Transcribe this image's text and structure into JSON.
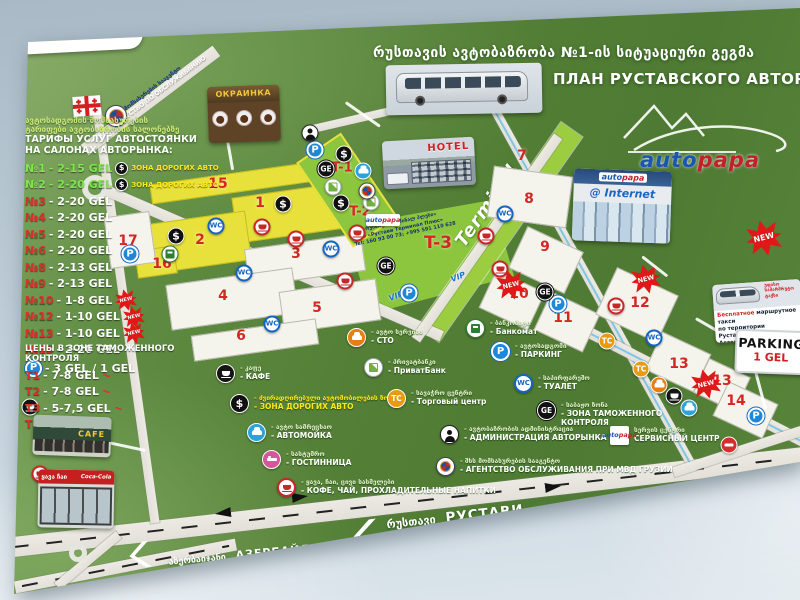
{
  "poster": {
    "title_ka": "რუსთავის ავტობაზრობა №1-ის სიტუაციური გეგმა",
    "title_ru": "ПЛАН РУСТАВСКОГО АВТОРЫНКА №1"
  },
  "badges": {
    "new_label": "NEW"
  },
  "tariff_board": {
    "header_ka1": "ავტოსადგომის მომსახურების",
    "header_ka2": "ტარიფები ავტობაზრობის სალონებზე",
    "header_ru1": "ТАРИФЫ УСЛУГ АВТОСТОЯНКИ",
    "header_ru2": "НА САЛОНАХ АВТОРЫНКА:",
    "rows": [
      {
        "label": "№1",
        "price": "- 2-15 GEL",
        "accent": "green",
        "dollar": true,
        "zone": "ЗОНА ДОРОГИХ АВТО"
      },
      {
        "label": "№2",
        "price": "- 2-20 GEL",
        "accent": "green",
        "dollar": true,
        "zone": "ЗОНА ДОРОГИХ АВТО"
      },
      {
        "label": "№3",
        "price": "- 2-20 GEL",
        "accent": "red"
      },
      {
        "label": "№4",
        "price": "- 2-20 GEL",
        "accent": "red"
      },
      {
        "label": "№5",
        "price": "- 2-20 GEL",
        "accent": "red"
      },
      {
        "label": "№6",
        "price": "- 2-20 GEL",
        "accent": "red"
      },
      {
        "label": "№8",
        "price": "- 2-13 GEL",
        "accent": "red"
      },
      {
        "label": "№9",
        "price": "- 2-13 GEL",
        "accent": "red"
      },
      {
        "label": "№10",
        "price": "- 1-8 GEL",
        "accent": "red",
        "new": true
      },
      {
        "label": "№12",
        "price": "- 1-10 GEL",
        "accent": "red",
        "new": true
      },
      {
        "label": "№13",
        "price": "- 1-10 GEL",
        "accent": "red",
        "new": true
      },
      {
        "label": "№15",
        "price": "- 2-20 GEL",
        "accent": "red"
      }
    ],
    "parking_price": "- 3 GEL / 1 GEL"
  },
  "customs_board": {
    "header": "ЦЕНЫ В ЗОНЕ ТАМОЖЕННОГО КОНТРОЛЯ",
    "rows": [
      {
        "label": "T1",
        "price": "- 7-8 GEL",
        "scribble": true
      },
      {
        "label": "T2",
        "price": "- 7-8 GEL",
        "scribble": true
      },
      {
        "label": "T3",
        "price": "- 5-7,5 GEL",
        "scribble": true
      },
      {
        "label": "T4",
        "price": "- 7 GEL",
        "scribble": false
      }
    ]
  },
  "legend": {
    "items": [
      {
        "icon": "cafe",
        "x": 226,
        "y": 374,
        "ka": "- კაფე",
        "ru": "- КАФЕ"
      },
      {
        "icon": "dollar",
        "x": 240,
        "y": 404,
        "ka": "- ძვირადღირებული ავტომობილების ზონა",
        "ru": "- ЗОНА ДОРОГИХ АВТО",
        "yellow": true
      },
      {
        "icon": "carwash",
        "x": 257,
        "y": 433,
        "ka": "- ავტო სამრეცხაო",
        "ru": "- АВТОМОЙКА"
      },
      {
        "icon": "bed",
        "x": 272,
        "y": 460,
        "ka": "- სასტუმრო",
        "ru": "- ГОСТИННИЦА"
      },
      {
        "icon": "coffee",
        "x": 287,
        "y": 488,
        "ka": "- ყავა, ჩაი, ცივი სასმელები",
        "ru": "- КОФЕ, ЧАЙ, ПРОХЛАДИТЕЛЬНЫЕ НАПИТКИ"
      },
      {
        "icon": "sto",
        "x": 357,
        "y": 338,
        "ka": "- ავტო სერვისი",
        "ru": "- СТО"
      },
      {
        "icon": "privat",
        "x": 374,
        "y": 368,
        "ka": "- პრივატბანკი",
        "ru": "- ПриватБанк"
      },
      {
        "icon": "tc",
        "x": 397,
        "y": 399,
        "ka": "- სავაჭრო ცენტრი",
        "ru": "- Торговый центр"
      },
      {
        "icon": "admin",
        "x": 450,
        "y": 435,
        "ka": "- ავტობაზრობის ადმინისტრაცია",
        "ru": "- АДМИНИСТРАЦИЯ АВТОРЫНКА"
      },
      {
        "icon": "emblem",
        "x": 446,
        "y": 467,
        "ka": "- შსს მომსახურების სააგენტო",
        "ru": "- АГЕНТСТВО ОБСЛУЖИВАНИЯ ПРИ МВД ГРУЗИИ"
      },
      {
        "icon": "atm",
        "x": 476,
        "y": 329,
        "ka": "- ბანკომატი",
        "ru": "- Банкомат"
      },
      {
        "icon": "parking",
        "x": 501,
        "y": 352,
        "ka": "- ავტოსადგომი",
        "ru": "- ПАРКИНГ"
      },
      {
        "icon": "wc",
        "x": 524,
        "y": 384,
        "ka": "- საპირფარეშო",
        "ru": "- ТУАЛЕТ"
      },
      {
        "icon": "ge",
        "x": 547,
        "y": 411,
        "ka": "- საბაჟო ზონა",
        "ru": "- ЗОНА ТАМОЖЕННОГО КОНТРОЛЯ",
        "wide": true
      },
      {
        "icon": "autopapa",
        "x": 620,
        "y": 436,
        "ka": "სერვის ცენტრი",
        "ru": "СЕРВИСНЫЙ ЦЕНТР"
      }
    ]
  },
  "map": {
    "terminal_label": "Terminal",
    "vip": "VIP",
    "mvd_road": {
      "ka": "შ.ს.ს. მომსახურების სააგენტო",
      "ru": "МВД - АГЕНТСТВО ПО ОБСЛУЖИВАНИЮ"
    },
    "t3_text": [
      "შპს «რუსთავი ტერმინალ პლუსი»",
      "ООО «Рустави Терминал Плюс»",
      "Tel: 160 93 00 73; +995 591 110 628"
    ],
    "roads": [
      {
        "cx": 400,
        "cy": 503,
        "len": 830,
        "wid": 20,
        "ang": -6.5,
        "dash": true
      },
      {
        "cx": 125,
        "cy": 566,
        "len": 225,
        "wid": 12,
        "ang": -11,
        "dash": true
      },
      {
        "cx": 88,
        "cy": 560,
        "len": 80,
        "wid": 9,
        "ang": -40
      },
      {
        "cx": 125,
        "cy": 312,
        "len": 425,
        "wid": 9,
        "ang": 82
      },
      {
        "cx": 150,
        "cy": 100,
        "len": 165,
        "wid": 13,
        "ang": -37
      },
      {
        "cx": 272,
        "cy": 262,
        "len": 370,
        "wid": 11,
        "ang": 23.5
      },
      {
        "cx": 585,
        "cy": 273,
        "len": 435,
        "wid": 9,
        "ang": 61,
        "blue": true
      },
      {
        "cx": 487,
        "cy": 238,
        "len": 248,
        "wid": 10,
        "ang": -55
      },
      {
        "cx": 677,
        "cy": 377,
        "len": 285,
        "wid": 11,
        "ang": 27,
        "blue": true
      },
      {
        "cx": 395,
        "cy": 110,
        "len": 180,
        "wid": 8,
        "ang": -13
      },
      {
        "cx": 742,
        "cy": 450,
        "len": 145,
        "wid": 10,
        "ang": -18
      }
    ],
    "plots": [
      {
        "cx": 232,
        "cy": 183,
        "w": 165,
        "h": 20,
        "ang": -8,
        "kind": "yellow"
      },
      {
        "cx": 296,
        "cy": 212,
        "w": 125,
        "h": 46,
        "ang": -8,
        "kind": "yellow"
      },
      {
        "cx": 193,
        "cy": 243,
        "w": 112,
        "h": 50,
        "ang": -8,
        "kind": "yellow"
      },
      {
        "cx": 156,
        "cy": 262,
        "w": 40,
        "h": 28,
        "ang": -8,
        "kind": "yellow"
      },
      {
        "cx": 305,
        "cy": 260,
        "w": 118,
        "h": 38,
        "ang": -8,
        "kind": "white"
      },
      {
        "cx": 232,
        "cy": 299,
        "w": 128,
        "h": 46,
        "ang": -8,
        "kind": "white"
      },
      {
        "cx": 330,
        "cy": 306,
        "w": 98,
        "h": 42,
        "ang": -8,
        "kind": "white"
      },
      {
        "cx": 255,
        "cy": 340,
        "w": 126,
        "h": 26,
        "ang": -8,
        "kind": "white"
      },
      {
        "cx": 130,
        "cy": 240,
        "w": 46,
        "h": 52,
        "ang": -8,
        "kind": "white"
      },
      {
        "cx": 347,
        "cy": 190,
        "w": 54,
        "h": 102,
        "ang": -34,
        "kind": "tzone"
      },
      {
        "cx": 530,
        "cy": 197,
        "w": 80,
        "h": 52,
        "ang": 8,
        "kind": "white"
      },
      {
        "cx": 546,
        "cy": 260,
        "w": 62,
        "h": 46,
        "ang": 25,
        "kind": "white"
      },
      {
        "cx": 512,
        "cy": 300,
        "w": 54,
        "h": 42,
        "ang": 25,
        "kind": "white"
      },
      {
        "cx": 567,
        "cy": 322,
        "w": 54,
        "h": 42,
        "ang": 25,
        "kind": "white"
      },
      {
        "cx": 637,
        "cy": 305,
        "w": 68,
        "h": 52,
        "ang": 25,
        "kind": "white"
      },
      {
        "cx": 678,
        "cy": 362,
        "w": 54,
        "h": 42,
        "ang": 25,
        "kind": "white"
      },
      {
        "cx": 722,
        "cy": 385,
        "w": 46,
        "h": 38,
        "ang": 25,
        "kind": "white"
      },
      {
        "cx": 745,
        "cy": 410,
        "w": 55,
        "h": 38,
        "ang": 25,
        "kind": "white"
      }
    ],
    "numbers": [
      {
        "n": "15",
        "x": 218,
        "y": 184
      },
      {
        "n": "1",
        "x": 260,
        "y": 203
      },
      {
        "n": "2",
        "x": 200,
        "y": 240
      },
      {
        "n": "3",
        "x": 296,
        "y": 254
      },
      {
        "n": "4",
        "x": 223,
        "y": 296
      },
      {
        "n": "5",
        "x": 317,
        "y": 308
      },
      {
        "n": "6",
        "x": 241,
        "y": 336
      },
      {
        "n": "16",
        "x": 162,
        "y": 264
      },
      {
        "n": "17",
        "x": 128,
        "y": 241
      },
      {
        "n": "7",
        "x": 522,
        "y": 156
      },
      {
        "n": "8",
        "x": 529,
        "y": 199
      },
      {
        "n": "9",
        "x": 545,
        "y": 247
      },
      {
        "n": "10",
        "x": 519,
        "y": 294
      },
      {
        "n": "11",
        "x": 563,
        "y": 318
      },
      {
        "n": "12",
        "x": 640,
        "y": 303
      },
      {
        "n": "13",
        "x": 679,
        "y": 364
      },
      {
        "n": "13",
        "x": 722,
        "y": 381
      },
      {
        "n": "14",
        "x": 736,
        "y": 401
      },
      {
        "n": "T-1",
        "x": 342,
        "y": 168,
        "t": true
      },
      {
        "n": "T-2",
        "x": 360,
        "y": 212,
        "t": true
      },
      {
        "n": "T-3",
        "x": 438,
        "y": 243,
        "big": true
      }
    ],
    "icons": [
      {
        "t": "dollar",
        "x": 283,
        "y": 204
      },
      {
        "t": "dollar",
        "x": 176,
        "y": 236
      },
      {
        "t": "dollar",
        "x": 344,
        "y": 154
      },
      {
        "t": "dollar",
        "x": 341,
        "y": 203
      },
      {
        "t": "wc",
        "x": 216,
        "y": 226
      },
      {
        "t": "wc",
        "x": 244,
        "y": 273
      },
      {
        "t": "wc",
        "x": 272,
        "y": 324
      },
      {
        "t": "wc",
        "x": 331,
        "y": 249
      },
      {
        "t": "wc",
        "x": 505,
        "y": 214
      },
      {
        "t": "wc",
        "x": 654,
        "y": 338
      },
      {
        "t": "coffee",
        "x": 262,
        "y": 227
      },
      {
        "t": "coffee",
        "x": 296,
        "y": 239
      },
      {
        "t": "coffee",
        "x": 345,
        "y": 281
      },
      {
        "t": "coffee",
        "x": 357,
        "y": 233
      },
      {
        "t": "coffee",
        "x": 486,
        "y": 236
      },
      {
        "t": "coffee",
        "x": 500,
        "y": 269
      },
      {
        "t": "coffee",
        "x": 616,
        "y": 306
      },
      {
        "t": "coffee",
        "x": 40,
        "y": 474
      },
      {
        "t": "parking",
        "x": 315,
        "y": 150
      },
      {
        "t": "parking",
        "x": 130,
        "y": 254
      },
      {
        "t": "parking",
        "x": 409,
        "y": 293
      },
      {
        "t": "parking",
        "x": 558,
        "y": 304
      },
      {
        "t": "parking",
        "x": 756,
        "y": 416
      },
      {
        "t": "ge",
        "x": 326,
        "y": 169
      },
      {
        "t": "ge",
        "x": 386,
        "y": 266
      },
      {
        "t": "ge",
        "x": 545,
        "y": 292
      },
      {
        "t": "privat",
        "x": 333,
        "y": 187
      },
      {
        "t": "privat",
        "x": 371,
        "y": 202
      },
      {
        "t": "carwash",
        "x": 363,
        "y": 171
      },
      {
        "t": "carwash",
        "x": 689,
        "y": 408
      },
      {
        "t": "admin",
        "x": 310,
        "y": 133
      },
      {
        "t": "atm",
        "x": 170,
        "y": 254
      },
      {
        "t": "tc",
        "x": 607,
        "y": 341
      },
      {
        "t": "tc",
        "x": 641,
        "y": 369
      },
      {
        "t": "new",
        "x": 511,
        "y": 285
      },
      {
        "t": "new",
        "x": 646,
        "y": 279
      },
      {
        "t": "new",
        "x": 706,
        "y": 384
      },
      {
        "t": "noentry",
        "x": 729,
        "y": 445
      },
      {
        "t": "cafe",
        "x": 674,
        "y": 396
      },
      {
        "t": "cafe",
        "x": 30,
        "y": 407
      },
      {
        "t": "sto",
        "x": 659,
        "y": 385
      },
      {
        "t": "emblem",
        "x": 367,
        "y": 191
      },
      {
        "t": "autopapa",
        "x": 383,
        "y": 220
      }
    ],
    "leaders": [
      {
        "cx": 122,
        "cy": 444,
        "len": 48,
        "ang": 12
      },
      {
        "cx": 230,
        "cy": 152,
        "len": 34,
        "ang": 80
      },
      {
        "cx": 363,
        "cy": 113,
        "len": 42,
        "ang": 35
      },
      {
        "cx": 655,
        "cy": 265,
        "len": 32,
        "ang": 38
      },
      {
        "cx": 708,
        "cy": 324,
        "len": 28,
        "ang": 30
      },
      {
        "cx": 760,
        "cy": 386,
        "len": 46,
        "ang": 75
      }
    ]
  },
  "photos": {
    "hotel_label": "HOTEL",
    "ukrainka_label": "ОКРАИНКА",
    "internet_line1": "AutoPapa",
    "internet_line2": "@ Internet",
    "cafe_label": "CAFE",
    "kiosk_line1": "ყავა ჩაი",
    "kiosk_line2": "Coca-Cola",
    "bus_card": {
      "ka": "უფასო სამარშრუტო ტაქსი",
      "ru1": "Бесплатное",
      "ru2": " маршрутное такси",
      "ru3": "по территории Руставского",
      "ru4": "Авторынка №1"
    }
  },
  "salon_callout": {
    "ka": "სწრაფი გაყიდვების სალონი",
    "ru1": "Салон срочных",
    "ru2": "продаж"
  },
  "autopapa_logo": {
    "part1": "auto",
    "part2": "papa"
  },
  "parking_sign": {
    "line1": "PARKING",
    "line2": "1 GEL"
  },
  "highway_labels": {
    "rustavi_ka": "რუსთავი",
    "rustavi_ru": "РУСТАВИ",
    "tbilisi_ka": "თბილისი",
    "tbilisi_ru": "ТБИЛИСИ",
    "azerbaijan_ka": "აზერბაიჯანი",
    "azerbaijan_ru": "АЗЕРБАЙДЖАН"
  }
}
